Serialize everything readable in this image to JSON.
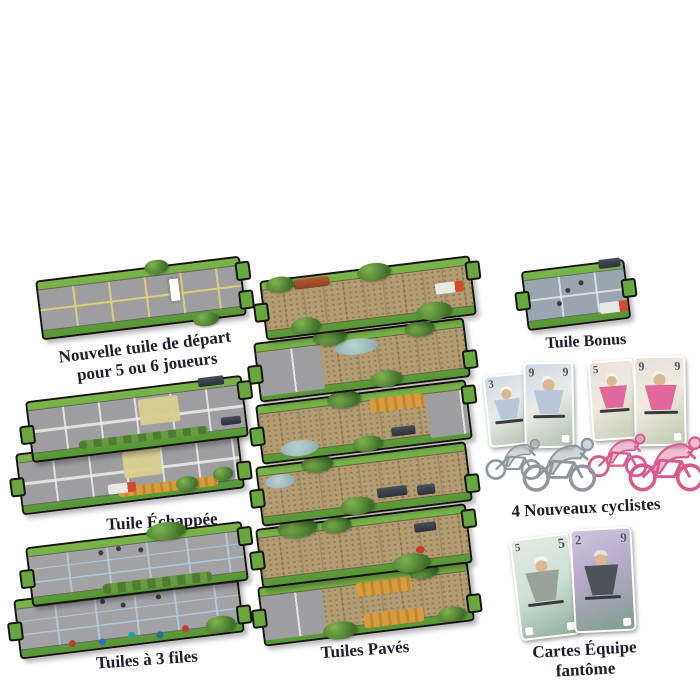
{
  "product": "Flamme Rouge expansion components overview",
  "captions": {
    "start_tile_line1": "Nouvelle tuile de départ",
    "start_tile_line2": "pour 5 ou 6 joueurs",
    "echappee": "Tuile Échappée",
    "three_files": "Tuiles à 3 files",
    "paves": "Tuiles Pavés",
    "bonus": "Tuile Bonus",
    "new_cyclists": "4 Nouveaux cyclistes",
    "ghost_line1": "Cartes Équipe",
    "ghost_line2": "fantôme"
  },
  "cards": {
    "new_cyclists": [
      {
        "team": "white",
        "corner_left": "3"
      },
      {
        "team": "white",
        "corner_left": "9",
        "corner_right": "9"
      },
      {
        "team": "pink",
        "corner_left": "5"
      },
      {
        "team": "pink",
        "corner_left": "9",
        "corner_right": "9"
      }
    ],
    "ghost": [
      {
        "corner_left": "5",
        "corner_right": "5"
      },
      {
        "corner_left": "2",
        "corner_right": "9"
      }
    ]
  },
  "counts": {
    "pave_tiles_shown": 6,
    "echappee_tiles_shown": 2,
    "three_file_tiles_shown": 2,
    "cyclist_figures": 4
  },
  "colors": {
    "background": "#ffffff",
    "tile_grass_green": "#6cae41",
    "road_gray": "#9e9ea0",
    "pave_tan": "#b29c72",
    "lane_yellow": "#d9cf8e",
    "lane_blue": "#aecbdc",
    "team_pink": "#e2679a",
    "team_white": "#aeb4ba",
    "caption_text": "#1d1d2b"
  }
}
